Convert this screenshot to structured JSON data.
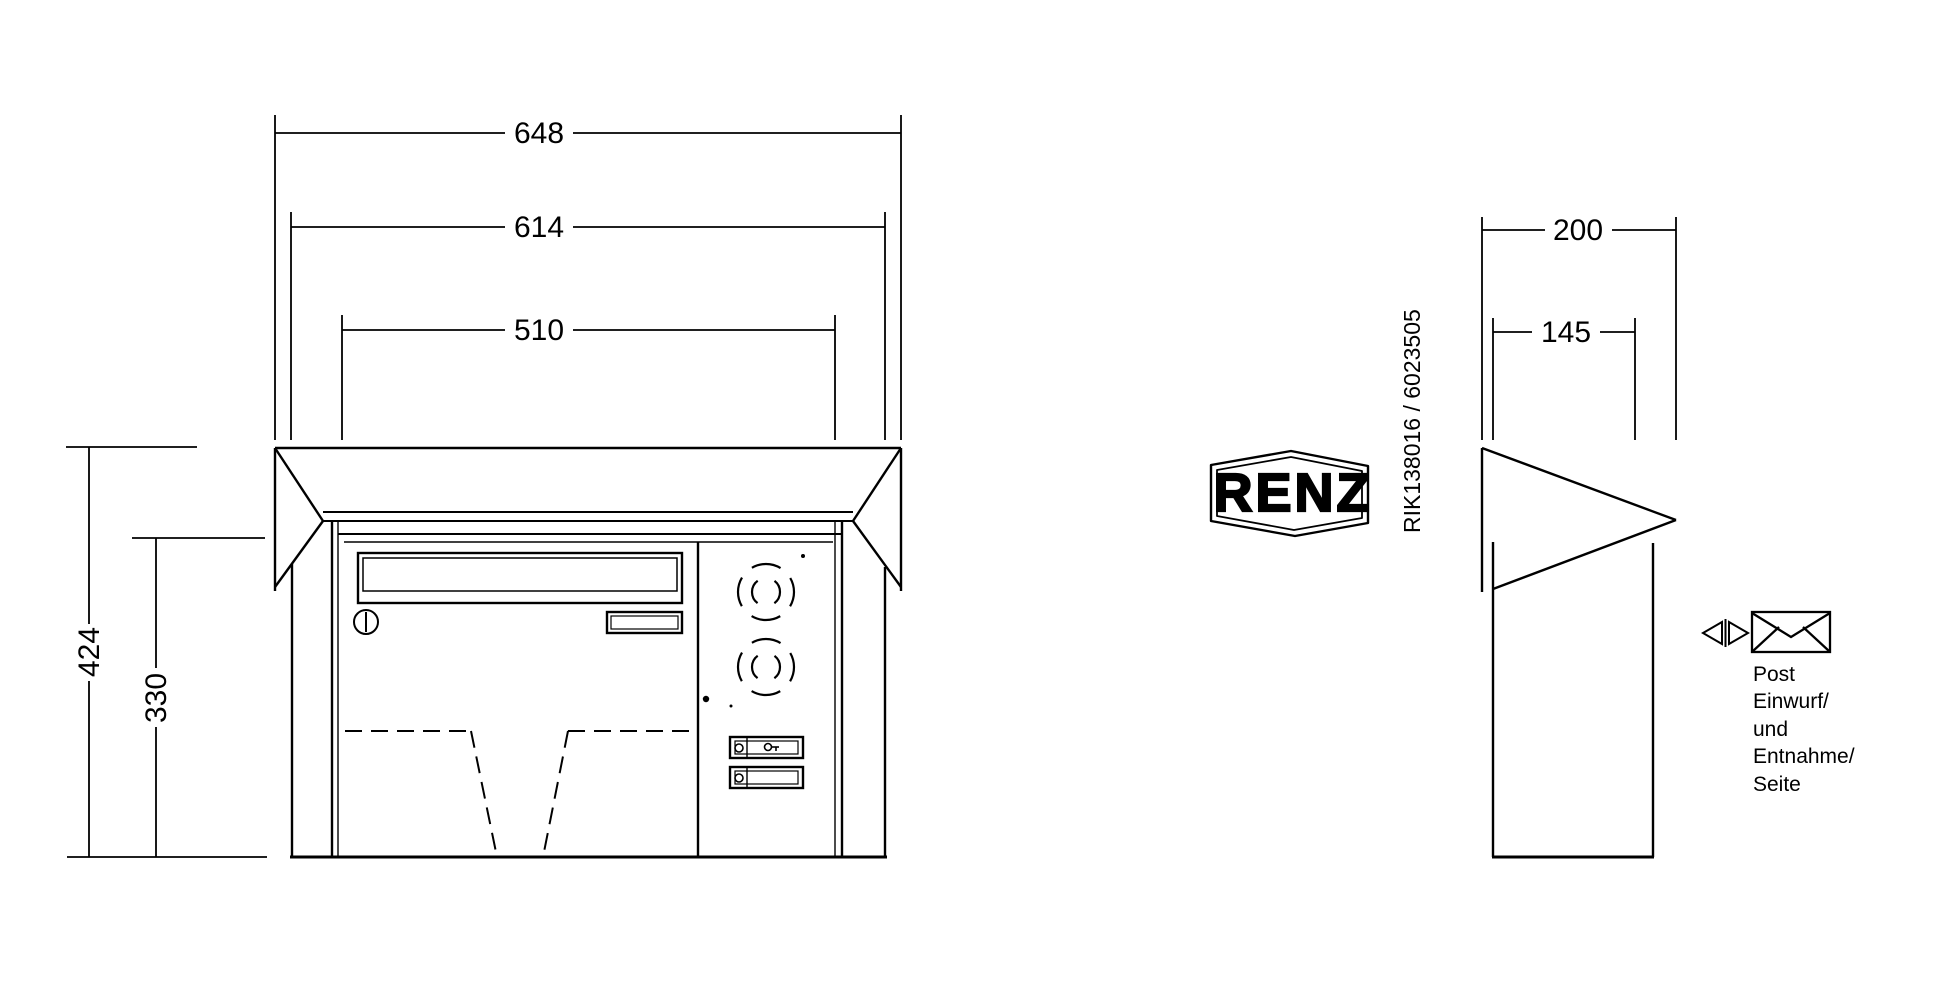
{
  "document": {
    "kind": "mailbox technical dimension drawing",
    "background_color": "#ffffff",
    "line_color": "#000000"
  },
  "front_view": {
    "dims": {
      "width_overall": "648",
      "width_body": "614",
      "width_door": "510",
      "height_overall": "424",
      "height_body": "330"
    }
  },
  "side_view": {
    "dims": {
      "depth_overall": "200",
      "depth_body": "145"
    }
  },
  "branding": {
    "logo": "RENZ"
  },
  "part_number": "RIK138016 / 6023505",
  "legend": {
    "lines": [
      "Post",
      "Einwurf/",
      "und",
      "Entnahme/",
      "Seite"
    ]
  },
  "icons": {
    "speaker": "intercom-speaker-grille",
    "bell": "bell-button",
    "lock": "cylinder-lock",
    "envelope": "mail-envelope",
    "arrows": "left-right-arrows"
  }
}
